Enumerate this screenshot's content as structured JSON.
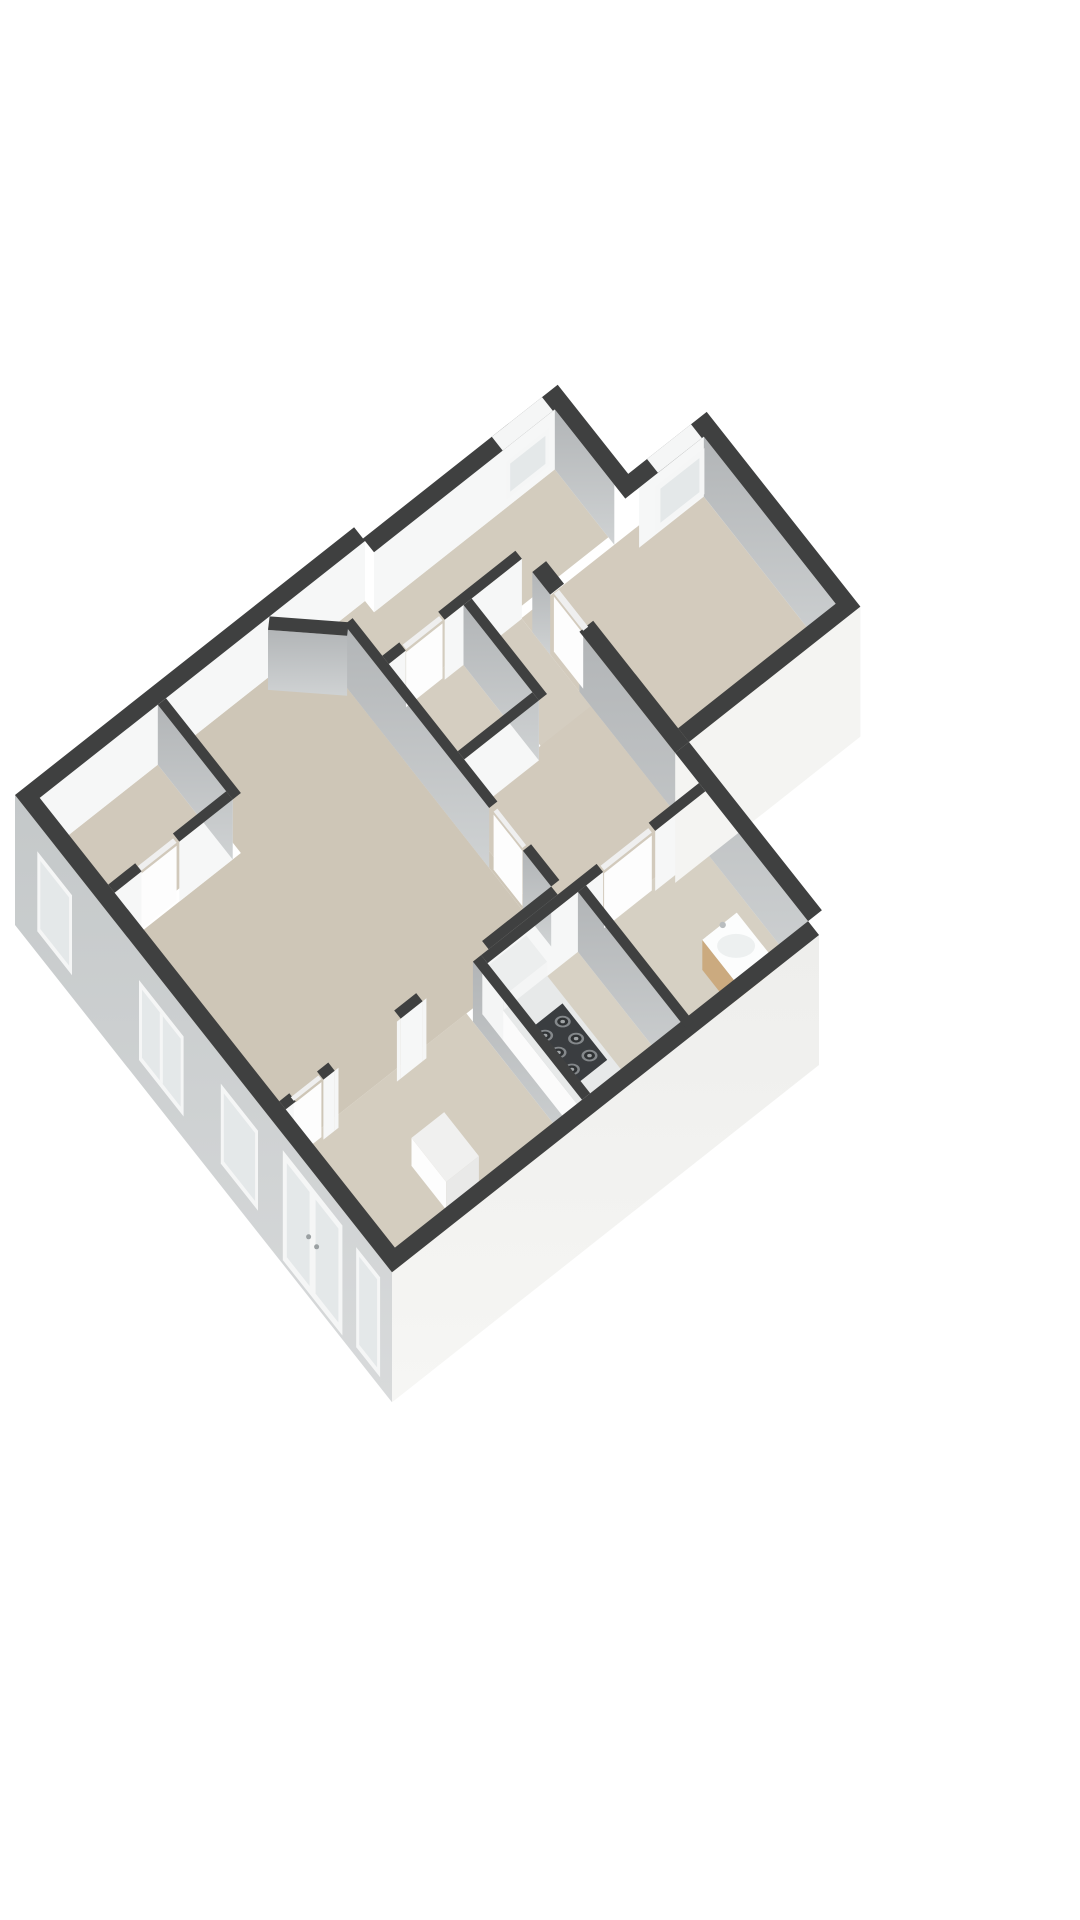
{
  "scene": {
    "background": "#ffffff",
    "view": "axonometric-3d-floor-plan"
  },
  "palette": {
    "wall_top": "#3f4040",
    "wall_face_white": "#f6f7f7",
    "wall_face_gray_top": "#b2b5b7",
    "wall_face_gray_bottom": "#cfd2d3",
    "facade_sw_top": "#c4c8c9",
    "facade_sw_bottom": "#d8dadb",
    "facade_se": "#f2f2f0",
    "facade_se2": "#f4f4f2",
    "window_frame": "#f5f6f6",
    "window_glass": "#e4e8e9",
    "door_leaf_top": "#efefef",
    "door_leaf_face": "#fdfdfd",
    "counter_top": "#e7e9e9",
    "counter_face": "#fbfbfb",
    "tall_unit_top": "#eceeee",
    "tall_unit_face": "#f4f5f5",
    "hob_body": "#3a3d40",
    "burner_ring": "#84888b",
    "burner_center": "#2f3234",
    "burner_cap": "#a0a4a6",
    "cabinet_top": "#f0f0ef",
    "cabinet_face_left": "#fdfdfd",
    "cabinet_face_right": "#e9e9e8",
    "vanity_wood_left": "#cbaa7f",
    "vanity_wood_right": "#b6905c",
    "sink_top": "#fcfdfd",
    "sink_basin": "#edf0f0",
    "faucet": "#b9bdbf"
  },
  "rooms": [
    {
      "id": "living-room",
      "floor": "#cec6b7"
    },
    {
      "id": "bedroom",
      "floor": "#d4cdbf"
    },
    {
      "id": "kitchen",
      "floor": "#d7d1c4"
    },
    {
      "id": "bathroom",
      "floor": "#d6d0c3"
    },
    {
      "id": "toilet",
      "floor": "#d5cec1"
    },
    {
      "id": "inner-hall",
      "floor": "#d2cabc"
    },
    {
      "id": "corridor",
      "floor": "#d3ccbe"
    },
    {
      "id": "closet",
      "floor": "#d1c9bb"
    },
    {
      "id": "storage-nook",
      "floor": "#d4cdc0"
    },
    {
      "id": "bedroom-right",
      "floor": "#d3cbbd"
    }
  ],
  "furniture": [
    {
      "id": "kitchen-counter"
    },
    {
      "id": "kitchen-tall-cabinet"
    },
    {
      "id": "gas-hob",
      "burners": 6
    },
    {
      "id": "bedroom-cabinet"
    },
    {
      "id": "bathroom-vanity"
    },
    {
      "id": "vanity-sink"
    }
  ],
  "openings": {
    "sw_facade_windows": 5,
    "french_door_sets": 1,
    "band_windows": 2,
    "interior_door_leaves": 6,
    "interior_wall_openings": 2
  }
}
